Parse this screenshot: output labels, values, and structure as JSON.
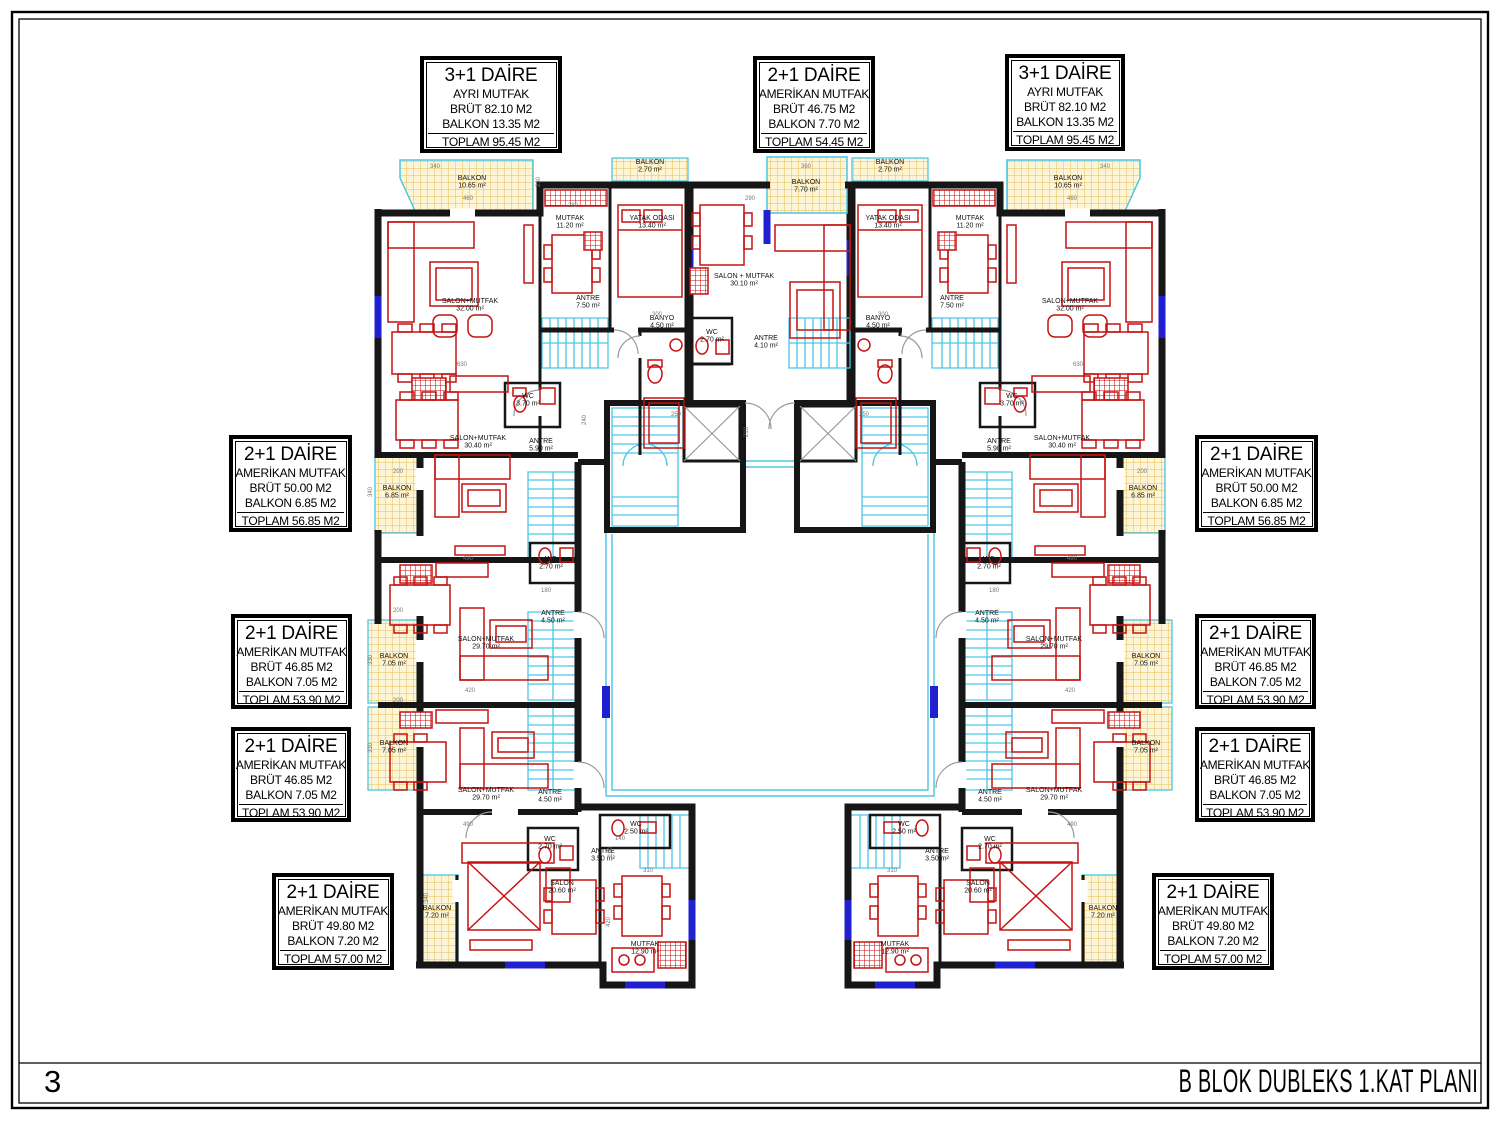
{
  "sheet": {
    "number": "3",
    "title": "B BLOK DUBLEKS 1.KAT PLANI"
  },
  "colors": {
    "walls": "#161616",
    "furniture": "#c61212",
    "balcony_hatch": "#e7bd55",
    "balcony_bg": "#fdf5d8",
    "stairs": "#49c6e5",
    "window": "#2020d0",
    "dims": "#777777",
    "door_arc": "#9a9a9a"
  },
  "apartments": [
    {
      "type": "3+1 DAİRE",
      "kitchen": "AYRI MUTFAK",
      "brut": "BRÜT 82.10 M2",
      "balkon": "BALKON 13.35 M2",
      "toplam": "TOPLAM 95.45 M2"
    },
    {
      "type": "2+1 DAİRE",
      "kitchen": "AMERİKAN MUTFAK",
      "brut": "BRÜT 46.75 M2",
      "balkon": "BALKON 7.70 M2",
      "toplam": "TOPLAM 54.45 M2"
    },
    {
      "type": "3+1 DAİRE",
      "kitchen": "AYRI MUTFAK",
      "brut": "BRÜT 82.10 M2",
      "balkon": "BALKON 13.35 M2",
      "toplam": "TOPLAM 95.45 M2"
    },
    {
      "type": "2+1 DAİRE",
      "kitchen": "AMERİKAN MUTFAK",
      "brut": "BRÜT 50.00 M2",
      "balkon": "BALKON 6.85 M2",
      "toplam": "TOPLAM 56.85 M2"
    },
    {
      "type": "2+1 DAİRE",
      "kitchen": "AMERİKAN MUTFAK",
      "brut": "BRÜT 46.85 M2",
      "balkon": "BALKON 7.05 M2",
      "toplam": "TOPLAM 53.90 M2"
    },
    {
      "type": "2+1 DAİRE",
      "kitchen": "AMERİKAN MUTFAK",
      "brut": "BRÜT 46.85 M2",
      "balkon": "BALKON 7.05 M2",
      "toplam": "TOPLAM 53.90 M2"
    },
    {
      "type": "2+1 DAİRE",
      "kitchen": "AMERİKAN MUTFAK",
      "brut": "BRÜT 49.80 M2",
      "balkon": "BALKON 7.20 M2",
      "toplam": "TOPLAM 57.00 M2"
    },
    {
      "type": "2+1 DAİRE",
      "kitchen": "AMERİKAN MUTFAK",
      "brut": "BRÜT 50.00 M2",
      "balkon": "BALKON 6.85 M2",
      "toplam": "TOPLAM 56.85 M2"
    },
    {
      "type": "2+1 DAİRE",
      "kitchen": "AMERİKAN MUTFAK",
      "brut": "BRÜT 46.85 M2",
      "balkon": "BALKON 7.05 M2",
      "toplam": "TOPLAM 53.90 M2"
    },
    {
      "type": "2+1 DAİRE",
      "kitchen": "AMERİKAN MUTFAK",
      "brut": "BRÜT 46.85 M2",
      "balkon": "BALKON 7.05 M2",
      "toplam": "TOPLAM 53.90 M2"
    },
    {
      "type": "2+1 DAİRE",
      "kitchen": "AMERİKAN MUTFAK",
      "brut": "BRÜT 49.80 M2",
      "balkon": "BALKON 7.20 M2",
      "toplam": "TOPLAM 57.00 M2"
    }
  ],
  "plan": {
    "rooms": [
      {
        "t": "BALKON",
        "a": "10.65 m²",
        "x": 472,
        "y": 180,
        "fs": 6.5
      },
      {
        "t": "BALKON",
        "a": "2.70 m²",
        "x": 650,
        "y": 164,
        "fs": 6
      },
      {
        "t": "SALON+MUTFAK",
        "a": "32.00 m²",
        "x": 470,
        "y": 303
      },
      {
        "t": "MUTFAK",
        "a": "11.20 m²",
        "x": 570,
        "y": 220,
        "fs": 6.5
      },
      {
        "t": "YATAK ODASI",
        "a": "13.40 m²",
        "x": 652,
        "y": 220,
        "fs": 6.5
      },
      {
        "t": "ANTRE",
        "a": "7.50 m²",
        "x": 588,
        "y": 300,
        "fs": 6.5
      },
      {
        "t": "BANYO",
        "a": "4.50 m²",
        "x": 662,
        "y": 320,
        "fs": 6.5
      },
      {
        "t": "WC",
        "a": "3.70 m²",
        "x": 528,
        "y": 398,
        "fs": 6.5
      },
      {
        "t": "SALON+MUTFAK",
        "a": "30.40 m²",
        "x": 478,
        "y": 440
      },
      {
        "t": "ANTRE",
        "a": "5.90 m²",
        "x": 541,
        "y": 443,
        "fs": 6.5
      },
      {
        "t": "BALKON",
        "a": "6.85 m²",
        "x": 397,
        "y": 490,
        "fs": 6.5
      },
      {
        "t": "WC",
        "a": "2.70 m²",
        "x": 551,
        "y": 561,
        "fs": 6.5
      },
      {
        "t": "SALON+MUTFAK",
        "a": "29.70 m²",
        "x": 486,
        "y": 641
      },
      {
        "t": "ANTRE",
        "a": "4.50 m²",
        "x": 553,
        "y": 615,
        "fs": 6.5
      },
      {
        "t": "BALKON",
        "a": "7.05 m²",
        "x": 394,
        "y": 658,
        "fs": 6.5
      },
      {
        "t": "BALKON",
        "a": "7.05 m²",
        "x": 394,
        "y": 745,
        "fs": 6.5
      },
      {
        "t": "SALON+MUTFAK",
        "a": "29.70 m²",
        "x": 486,
        "y": 792
      },
      {
        "t": "ANTRE",
        "a": "4.50 m²",
        "x": 550,
        "y": 794,
        "fs": 6.5
      },
      {
        "t": "WC",
        "a": "2.70 m²",
        "x": 550,
        "y": 841,
        "fs": 6.5
      },
      {
        "t": "WC",
        "a": "2.50 m²",
        "x": 636,
        "y": 826,
        "fs": 6
      },
      {
        "t": "ANTRE",
        "a": "3.50 m²",
        "x": 603,
        "y": 853,
        "fs": 6.5
      },
      {
        "t": "SALON",
        "a": "20.60 m²",
        "x": 562,
        "y": 885
      },
      {
        "t": "MUTFAK",
        "a": "12.90 m²",
        "x": 645,
        "y": 946
      },
      {
        "t": "BALKON",
        "a": "7.20 m²",
        "x": 437,
        "y": 910,
        "fs": 6.5
      },
      {
        "t": "BALKON",
        "a": "7.70 m²",
        "x": 806,
        "y": 184,
        "fs": 6.5
      },
      {
        "t": "SALON + MUTFAK",
        "a": "30.10 m²",
        "x": 744,
        "y": 278
      },
      {
        "t": "WC",
        "a": "2.70 m²",
        "x": 712,
        "y": 334,
        "fs": 6.5
      },
      {
        "t": "ANTRE",
        "a": "4.10 m²",
        "x": 766,
        "y": 340,
        "fs": 6.5
      },
      {
        "t": "BALKON",
        "a": "10.65 m²",
        "x": 1068,
        "y": 180,
        "fs": 6.5
      },
      {
        "t": "BALKON",
        "a": "2.70 m²",
        "x": 890,
        "y": 164,
        "fs": 6
      },
      {
        "t": "SALON+MUTFAK",
        "a": "32.00 m²",
        "x": 1070,
        "y": 303
      },
      {
        "t": "MUTFAK",
        "a": "11.20 m²",
        "x": 970,
        "y": 220,
        "fs": 6.5
      },
      {
        "t": "YATAK ODASI",
        "a": "13.40 m²",
        "x": 888,
        "y": 220,
        "fs": 6.5
      },
      {
        "t": "ANTRE",
        "a": "7.50 m²",
        "x": 952,
        "y": 300,
        "fs": 6.5
      },
      {
        "t": "BANYO",
        "a": "4.50 m²",
        "x": 878,
        "y": 320,
        "fs": 6.5
      },
      {
        "t": "WC",
        "a": "3.70 m²",
        "x": 1012,
        "y": 398,
        "fs": 6.5
      },
      {
        "t": "SALON+MUTFAK",
        "a": "30.40 m²",
        "x": 1062,
        "y": 440
      },
      {
        "t": "ANTRE",
        "a": "5.90 m²",
        "x": 999,
        "y": 443,
        "fs": 6.5
      },
      {
        "t": "BALKON",
        "a": "6.85 m²",
        "x": 1143,
        "y": 490,
        "fs": 6.5
      },
      {
        "t": "WC",
        "a": "2.70 m²",
        "x": 989,
        "y": 561,
        "fs": 6.5
      },
      {
        "t": "SALON+MUTFAK",
        "a": "29.70 m²",
        "x": 1054,
        "y": 641
      },
      {
        "t": "ANTRE",
        "a": "4.50 m²",
        "x": 987,
        "y": 615,
        "fs": 6.5
      },
      {
        "t": "BALKON",
        "a": "7.05 m²",
        "x": 1146,
        "y": 658,
        "fs": 6.5
      },
      {
        "t": "BALKON",
        "a": "7.05 m²",
        "x": 1146,
        "y": 745,
        "fs": 6.5
      },
      {
        "t": "SALON+MUTFAK",
        "a": "29.70 m²",
        "x": 1054,
        "y": 792
      },
      {
        "t": "ANTRE",
        "a": "4.50 m²",
        "x": 990,
        "y": 794,
        "fs": 6.5
      },
      {
        "t": "WC",
        "a": "2.70 m²",
        "x": 990,
        "y": 841,
        "fs": 6.5
      },
      {
        "t": "WC",
        "a": "2.50 m²",
        "x": 904,
        "y": 826,
        "fs": 6
      },
      {
        "t": "ANTRE",
        "a": "3.50 m²",
        "x": 937,
        "y": 853,
        "fs": 6.5
      },
      {
        "t": "SALON",
        "a": "20.60 m²",
        "x": 978,
        "y": 885
      },
      {
        "t": "MUTFAK",
        "a": "12.90 m²",
        "x": 895,
        "y": 946
      },
      {
        "t": "BALKON",
        "a": "7.20 m²",
        "x": 1103,
        "y": 910,
        "fs": 6.5
      }
    ],
    "dims": [
      {
        "t": "340",
        "x": 435,
        "y": 168
      },
      {
        "t": "460",
        "x": 468,
        "y": 200
      },
      {
        "t": "230",
        "x": 540,
        "y": 182,
        "r": 1
      },
      {
        "t": "280",
        "x": 573,
        "y": 207
      },
      {
        "t": "300",
        "x": 657,
        "y": 316
      },
      {
        "t": "630",
        "x": 462,
        "y": 366
      },
      {
        "t": "240",
        "x": 586,
        "y": 420,
        "r": 1
      },
      {
        "t": "200",
        "x": 398,
        "y": 473
      },
      {
        "t": "340",
        "x": 372,
        "y": 492,
        "r": 1
      },
      {
        "t": "490",
        "x": 468,
        "y": 560
      },
      {
        "t": "180",
        "x": 546,
        "y": 592
      },
      {
        "t": "420",
        "x": 470,
        "y": 692
      },
      {
        "t": "200",
        "x": 398,
        "y": 612
      },
      {
        "t": "330",
        "x": 372,
        "y": 660,
        "r": 1
      },
      {
        "t": "200",
        "x": 398,
        "y": 702
      },
      {
        "t": "330",
        "x": 372,
        "y": 748,
        "r": 1
      },
      {
        "t": "490",
        "x": 468,
        "y": 826
      },
      {
        "t": "310",
        "x": 648,
        "y": 872
      },
      {
        "t": "420",
        "x": 610,
        "y": 922,
        "r": 1
      },
      {
        "t": "340",
        "x": 428,
        "y": 898,
        "r": 1
      },
      {
        "t": "140",
        "x": 620,
        "y": 840
      },
      {
        "t": "110",
        "x": 612,
        "y": 852,
        "r": 1
      },
      {
        "t": "290",
        "x": 750,
        "y": 200
      },
      {
        "t": "360",
        "x": 806,
        "y": 168
      },
      {
        "t": "250",
        "x": 676,
        "y": 416
      },
      {
        "t": "210",
        "x": 748,
        "y": 432,
        "r": 1
      },
      {
        "t": "250",
        "x": 864,
        "y": 416
      },
      {
        "t": "340",
        "x": 1105,
        "y": 168
      },
      {
        "t": "460",
        "x": 1072,
        "y": 200
      },
      {
        "t": "300",
        "x": 883,
        "y": 316
      },
      {
        "t": "630",
        "x": 1078,
        "y": 366
      },
      {
        "t": "490",
        "x": 1072,
        "y": 560
      },
      {
        "t": "420",
        "x": 1070,
        "y": 692
      },
      {
        "t": "490",
        "x": 1072,
        "y": 826
      },
      {
        "t": "310",
        "x": 892,
        "y": 872
      },
      {
        "t": "200",
        "x": 1142,
        "y": 473
      },
      {
        "t": "180",
        "x": 994,
        "y": 592
      }
    ]
  }
}
